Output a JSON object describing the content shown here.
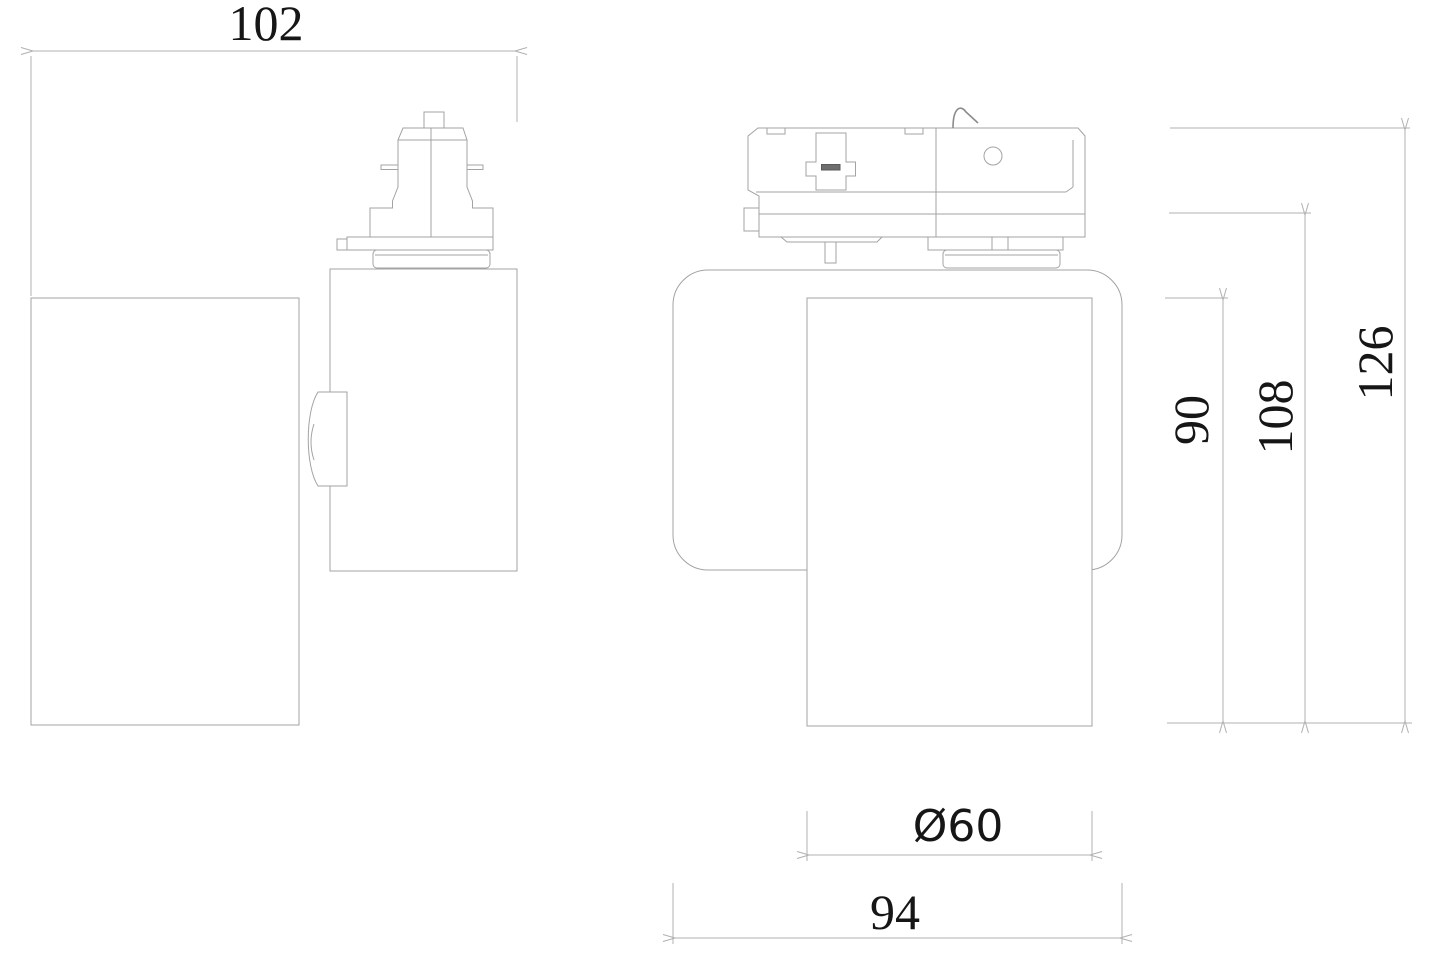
{
  "drawing": {
    "kind": "technical-dimension-drawing",
    "subject": "track-light-spotlight-two-views",
    "dimensions": {
      "overall_width": "102",
      "head_diameter": "Ø60",
      "body_width": "94",
      "head_height": "90",
      "body_height": "108",
      "overall_height": "126"
    },
    "colors": {
      "background": "#ffffff",
      "object_line": "#a3a3a3",
      "dimension_line": "#b0b0b0",
      "text": "#161616",
      "slot_fill": "#6e6e6e"
    }
  }
}
